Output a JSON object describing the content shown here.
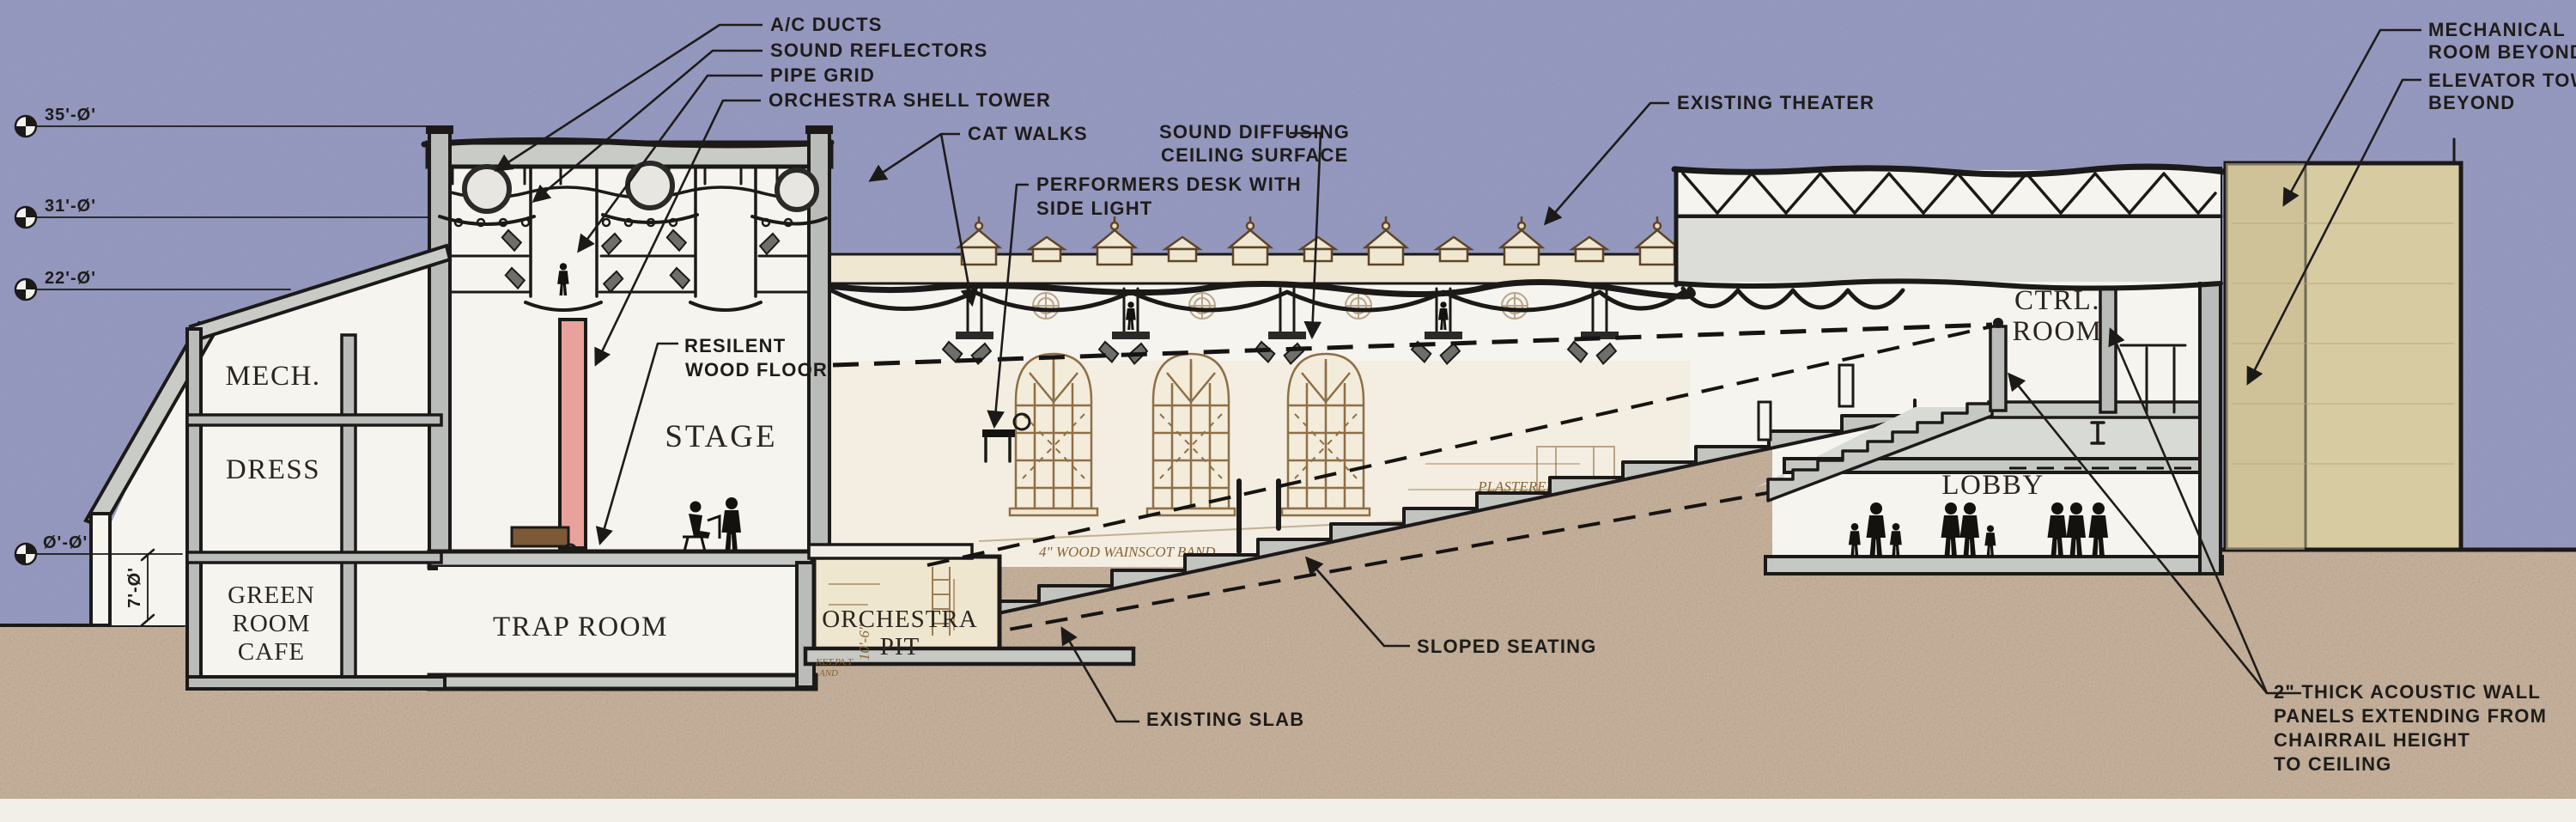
{
  "drawing": {
    "type": "architectural-section",
    "subject": "theater renovation longitudinal section"
  },
  "colors": {
    "sky": "#989cc3",
    "ground": "#c9b49e",
    "paper": "#f6f4ee",
    "sepia_paper": "#efe7d2",
    "sepia_ink": "#8a6335",
    "ink": "#1c1a18",
    "wall_gray": "#b9bcb8",
    "slab_gray": "#c6c8c4",
    "tan_block": "#d7cba2",
    "pink_shell": "#e9a29b",
    "brown_piano": "#7c5a36"
  },
  "annotations": {
    "ac_ducts": "A/C DUCTS",
    "sound_reflectors": "SOUND REFLECTORS",
    "pipe_grid": "PIPE GRID",
    "orchestra_shell_tower": "ORCHESTRA SHELL TOWER",
    "cat_walks": "CAT WALKS",
    "performers_desk_1": "PERFORMERS DESK WITH",
    "performers_desk_2": "SIDE LIGHT",
    "sound_diffusing_1": "SOUND DIFFUSING",
    "sound_diffusing_2": "CEILING SURFACE",
    "existing_theater": "EXISTING THEATER",
    "mechanical_room_1": "MECHANICAL",
    "mechanical_room_2": "ROOM BEYOND",
    "elevator_tower_1": "ELEVATOR TOWER",
    "elevator_tower_2": "BEYOND",
    "resilient_1": "RESILENT",
    "resilient_2": "WOOD FLOOR",
    "sloped_seating": "SLOPED SEATING",
    "existing_slab": "EXISTING SLAB",
    "acoustic_1": "2\" THICK ACOUSTIC WALL",
    "acoustic_2": "PANELS EXTENDING FROM",
    "acoustic_3": "CHAIRRAIL HEIGHT",
    "acoustic_4": "TO CEILING"
  },
  "rooms": {
    "mech": "MECH.",
    "dress": "DRESS",
    "green_1": "GREEN",
    "green_2": "ROOM",
    "green_3": "CAFE",
    "trap_room": "TRAP ROOM",
    "stage": "STAGE",
    "orchestra_1": "ORCHESTRA",
    "orchestra_2": "PIT",
    "ctrl_1": "CTRL.",
    "ctrl_2": "ROOM",
    "lobby": "LOBBY"
  },
  "elevations": {
    "e35": "35'-Ø'",
    "e31": "31'-Ø'",
    "e22": "22'-Ø'",
    "e0": "Ø'-Ø'",
    "v7": "7'-Ø'"
  },
  "existing_drawing_texts": {
    "plastered_1": "PLASTERED",
    "plastered_2": "RAIL'G",
    "wainscot": "4\" WOOD WAINSCOT BAND.",
    "dim_10_6": "10'-6\"",
    "fragment_1": "KET.PA.T",
    "fragment_2": "AND"
  }
}
